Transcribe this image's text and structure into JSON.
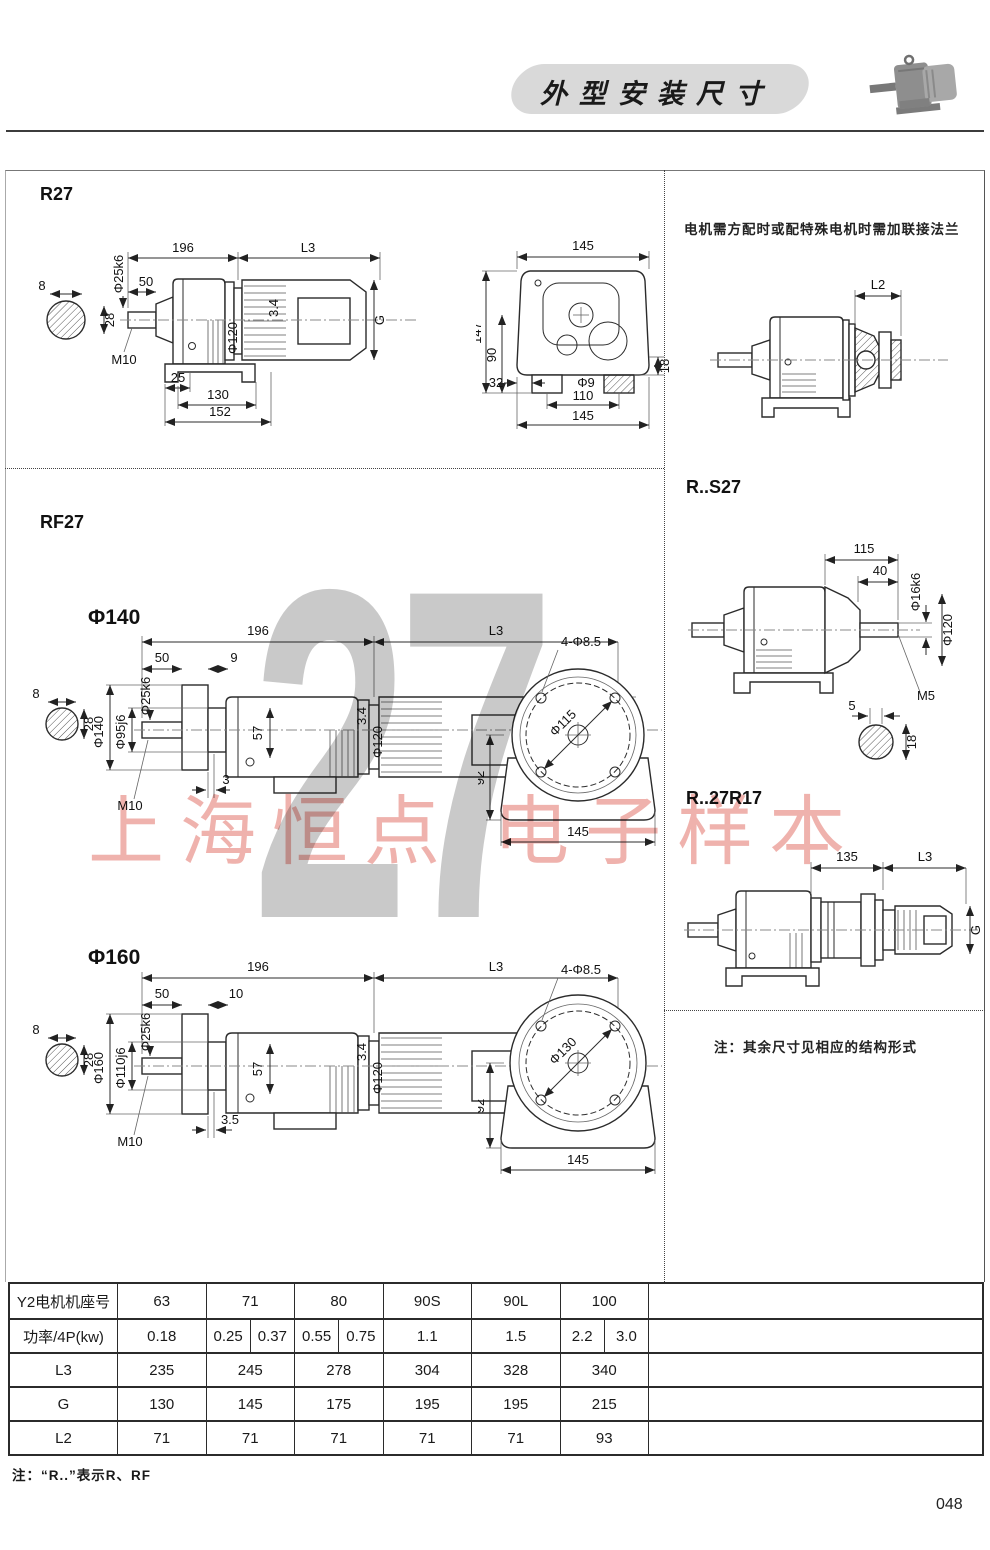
{
  "header": {
    "title": "外型安装尺寸"
  },
  "notes": {
    "flange": "电机需方配时或配特殊电机时需加联接法兰",
    "other_dims": "注：其余尺寸见相应的结构形式",
    "footer": "注：“R..”表示R、RF"
  },
  "page_number": "048",
  "watermark": {
    "big": "27",
    "text": "上海恒点 电子样本"
  },
  "sections": {
    "r27": "R27",
    "rf27": "RF27",
    "f140": "Φ140",
    "f160": "Φ160",
    "rs27": "R..S27",
    "r17": "R..27R17"
  },
  "dims": {
    "r27side": {
      "w196": "196",
      "L3": "L3",
      "w50": "50",
      "phi25": "Φ25k6",
      "phi120": "Φ120",
      "g34": "3.4",
      "G": "G",
      "M10": "M10",
      "w25": "25",
      "w130": "130",
      "w152": "152",
      "k8": "8",
      "k28": "28"
    },
    "r27end": {
      "t145": "145",
      "h147": "147",
      "h90": "90",
      "h18": "18",
      "w32": "32",
      "phi9": "Φ9",
      "w110": "110",
      "b145": "145"
    },
    "l2": {
      "L2": "L2"
    },
    "rs27": {
      "w115": "115",
      "w40": "40",
      "phi16": "Φ16k6",
      "phi120": "Φ120",
      "M5": "M5",
      "k5": "5",
      "k18": "18"
    },
    "r17": {
      "w135": "135",
      "L3": "L3",
      "G": "G"
    },
    "f140": {
      "w196": "196",
      "L3": "L3",
      "w50": "50",
      "w9": "9",
      "k8": "8",
      "k28": "28",
      "phi140": "Φ140",
      "phi95": "Φ95j6",
      "phi25": "Φ25k6",
      "h57": "57",
      "g34": "3.4",
      "phi120": "Φ120",
      "G": "G",
      "M10": "M10",
      "w3": "3",
      "holes": "4-Φ8.5",
      "phib": "Φ115",
      "h92": "92",
      "b145": "145"
    },
    "f160": {
      "w196": "196",
      "L3": "L3",
      "w50": "50",
      "w10": "10",
      "k8": "8",
      "k28": "28",
      "phi160": "Φ160",
      "phi110": "Φ110j6",
      "phi25": "Φ25k6",
      "h57": "57",
      "g34": "3.4",
      "phi120": "Φ120",
      "G": "G",
      "M10": "M10",
      "w35": "3.5",
      "holes": "4-Φ8.5",
      "phib": "Φ130",
      "h92": "92",
      "b145": "145"
    }
  },
  "table": {
    "rows": [
      {
        "label": "Y2电机机座号",
        "cells": [
          "63",
          "71",
          "80",
          "90S",
          "90L",
          "100"
        ]
      },
      {
        "label": "功率/4P(kw)",
        "cells": [
          "0.18",
          [
            "0.25",
            "0.37"
          ],
          [
            "0.55",
            "0.75"
          ],
          "1.1",
          "1.5",
          [
            "2.2",
            "3.0"
          ]
        ]
      },
      {
        "label": "L3",
        "cells": [
          "235",
          "245",
          "278",
          "304",
          "328",
          "340"
        ]
      },
      {
        "label": "G",
        "cells": [
          "130",
          "145",
          "175",
          "195",
          "195",
          "215"
        ]
      },
      {
        "label": "L2",
        "cells": [
          "71",
          "71",
          "71",
          "71",
          "71",
          "93"
        ]
      }
    ]
  }
}
